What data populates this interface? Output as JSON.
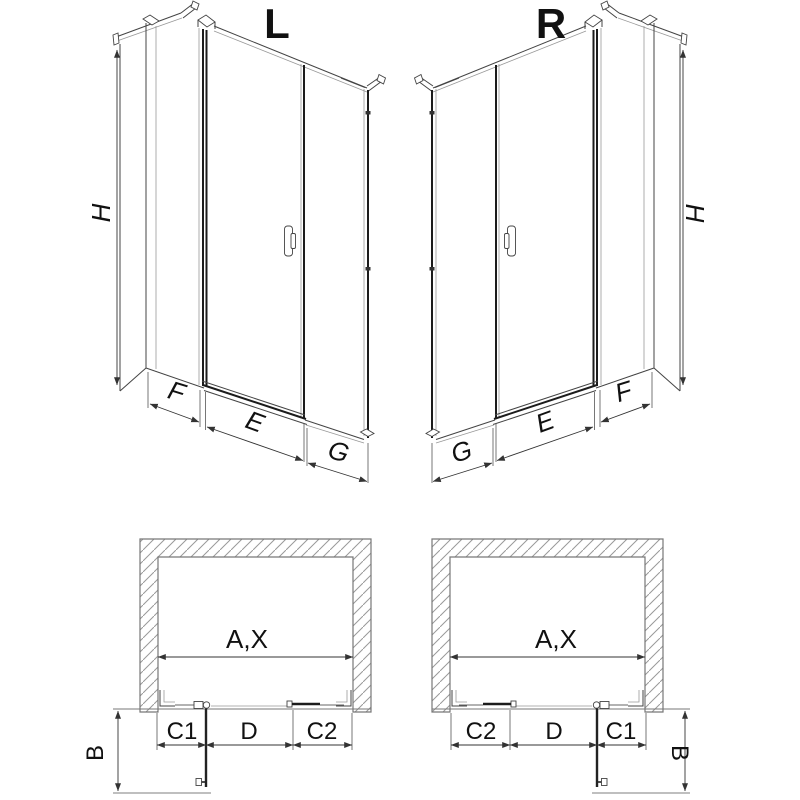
{
  "page": {
    "background": "#ffffff",
    "line_color": "#444444",
    "dark_profile_color": "#1c1c1c",
    "hatch_color": "#999999",
    "text_color": "#111111"
  },
  "iso_left": {
    "title": "L",
    "height_dim": "H",
    "side_panel_dim": "F",
    "door_dim": "E",
    "fixed_panel_dim": "G"
  },
  "iso_right": {
    "title": "R",
    "height_dim": "H",
    "side_panel_dim": "F",
    "door_dim": "E",
    "fixed_panel_dim": "G"
  },
  "plan_left": {
    "opening_dim": "A,X",
    "seg1": "C1",
    "seg2": "D",
    "seg3": "C2",
    "swing_dim": "B"
  },
  "plan_right": {
    "opening_dim": "A,X",
    "seg1": "C2",
    "seg2": "D",
    "seg3": "C1",
    "swing_dim": "B"
  }
}
